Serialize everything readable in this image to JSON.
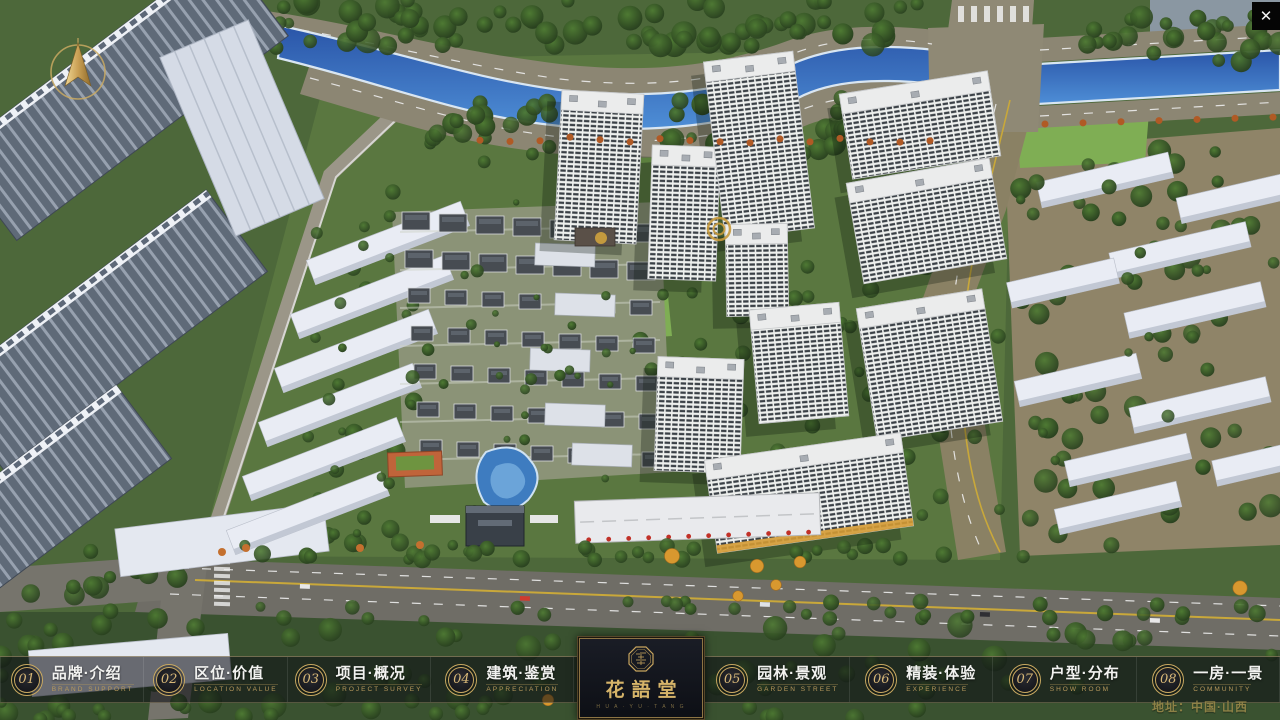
{
  "app": {
    "close_label": "✕"
  },
  "colors": {
    "gold_accent": "#c9a961",
    "gold_text": "#d8b878",
    "bar_background": "rgba(13,15,20,0.58)",
    "panel_background": "#0d0f15",
    "water": "#2a55a8",
    "address_text": "#9c8a4a"
  },
  "nav": {
    "items": [
      {
        "num": "01",
        "zh": "品牌·介绍",
        "en": "BRAND SUPPORT"
      },
      {
        "num": "02",
        "zh": "区位·价值",
        "en": "LOCATION VALUE"
      },
      {
        "num": "03",
        "zh": "项目·概况",
        "en": "PROJECT SURVEY"
      },
      {
        "num": "04",
        "zh": "建筑·鉴赏",
        "en": "APPRECIATION"
      },
      {
        "num": "05",
        "zh": "园林·景观",
        "en": "GARDEN STREET"
      },
      {
        "num": "06",
        "zh": "精装·体验",
        "en": "EXPERIENCE"
      },
      {
        "num": "07",
        "zh": "户型·分布",
        "en": "SHOW ROOM"
      },
      {
        "num": "08",
        "zh": "一房·一景",
        "en": "COMMUNITY"
      }
    ]
  },
  "logo": {
    "zh": "花語堂",
    "en": "H U A · Y U · T A N G"
  },
  "footer": {
    "address": "地址：中国·山西"
  }
}
